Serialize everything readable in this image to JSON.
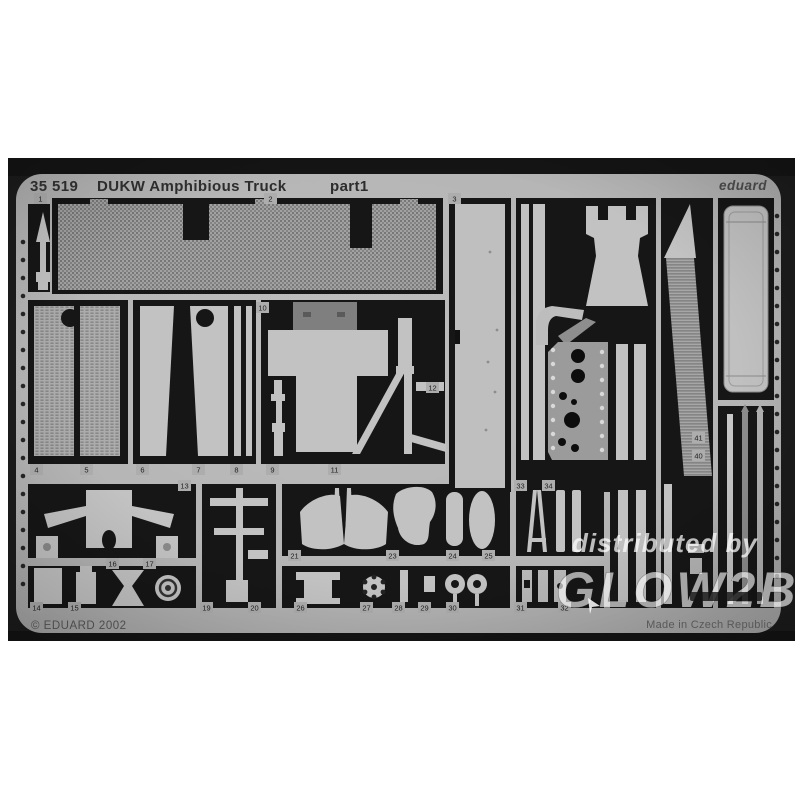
{
  "photo": {
    "header": {
      "catalog_number": "35 519",
      "title": "DUKW Amphibious Truck",
      "part_label": "part1",
      "brand": "eduard"
    },
    "footer": {
      "copyright": "© EDUARD 2002",
      "made_in": "Made in Czech Republic"
    },
    "watermark": {
      "line1": "distributed by",
      "line2": "GLOW2B"
    },
    "colors": {
      "page_background": "#ffffff",
      "photo_background": "#1c1c1c",
      "etched_opening": "#161616",
      "sheet_metal": "#b7b7b7",
      "part_metal": "#c2c2c2",
      "watermark_white": "#ffffff"
    },
    "part_tags": [
      {
        "label": "1",
        "x": 34,
        "y": 193
      },
      {
        "label": "2",
        "x": 264,
        "y": 193
      },
      {
        "label": "3",
        "x": 448,
        "y": 193
      },
      {
        "label": "4",
        "x": 30,
        "y": 464
      },
      {
        "label": "5",
        "x": 80,
        "y": 464
      },
      {
        "label": "6",
        "x": 136,
        "y": 464
      },
      {
        "label": "7",
        "x": 192,
        "y": 464
      },
      {
        "label": "8",
        "x": 230,
        "y": 464
      },
      {
        "label": "9",
        "x": 266,
        "y": 464
      },
      {
        "label": "10",
        "x": 256,
        "y": 302
      },
      {
        "label": "11",
        "x": 328,
        "y": 464
      },
      {
        "label": "12",
        "x": 426,
        "y": 382
      },
      {
        "label": "13",
        "x": 178,
        "y": 480
      },
      {
        "label": "14",
        "x": 30,
        "y": 602
      },
      {
        "label": "15",
        "x": 68,
        "y": 602
      },
      {
        "label": "16",
        "x": 106,
        "y": 558
      },
      {
        "label": "17",
        "x": 143,
        "y": 558
      },
      {
        "label": "19",
        "x": 200,
        "y": 602
      },
      {
        "label": "20",
        "x": 248,
        "y": 602
      },
      {
        "label": "21",
        "x": 288,
        "y": 550
      },
      {
        "label": "23",
        "x": 386,
        "y": 550
      },
      {
        "label": "24",
        "x": 446,
        "y": 550
      },
      {
        "label": "25",
        "x": 482,
        "y": 550
      },
      {
        "label": "26",
        "x": 294,
        "y": 602
      },
      {
        "label": "27",
        "x": 360,
        "y": 602
      },
      {
        "label": "28",
        "x": 392,
        "y": 602
      },
      {
        "label": "29",
        "x": 418,
        "y": 602
      },
      {
        "label": "30",
        "x": 446,
        "y": 602
      },
      {
        "label": "31",
        "x": 514,
        "y": 602
      },
      {
        "label": "32",
        "x": 558,
        "y": 602
      },
      {
        "label": "33",
        "x": 514,
        "y": 480
      },
      {
        "label": "34",
        "x": 542,
        "y": 480
      },
      {
        "label": "40",
        "x": 692,
        "y": 450
      },
      {
        "label": "41",
        "x": 692,
        "y": 432
      }
    ]
  }
}
